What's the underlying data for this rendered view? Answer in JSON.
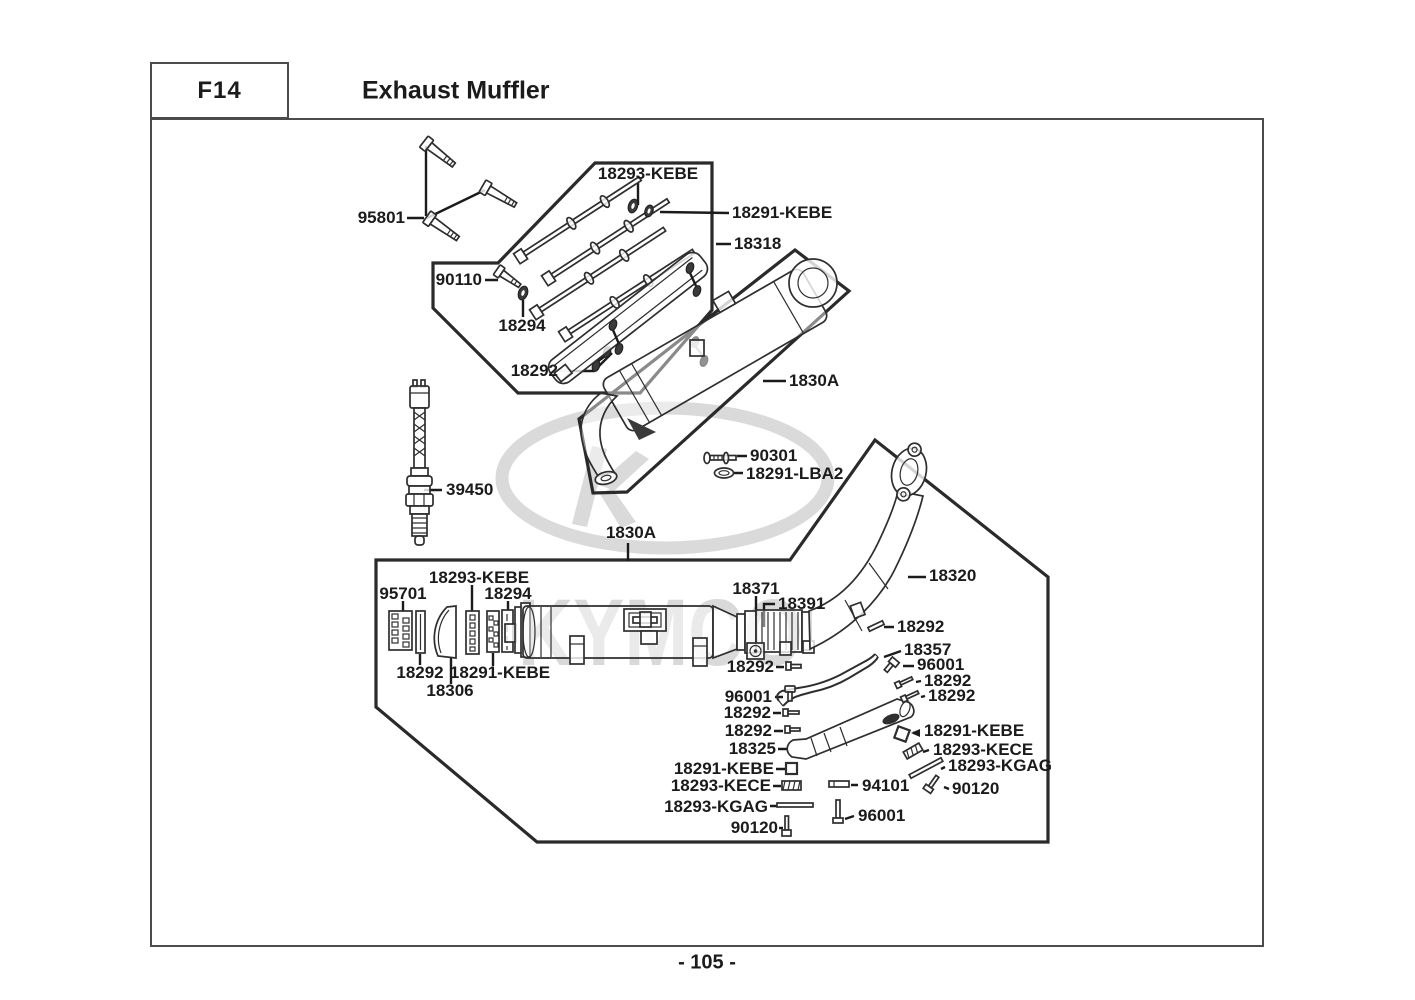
{
  "header": {
    "code": "F14",
    "title": "Exhaust Muffler"
  },
  "footer": {
    "page_number": "- 105 -"
  },
  "watermark": {
    "brand": "KYMCO"
  },
  "diagram": {
    "labels": [
      {
        "text": "95801",
        "x": 405,
        "y": 218,
        "align": "r"
      },
      {
        "text": "18293-KEBE",
        "x": 648,
        "y": 174,
        "align": "c"
      },
      {
        "text": "18291-KEBE",
        "x": 732,
        "y": 213,
        "align": "l"
      },
      {
        "text": "18318",
        "x": 734,
        "y": 244,
        "align": "l"
      },
      {
        "text": "90110",
        "x": 482,
        "y": 280,
        "align": "r"
      },
      {
        "text": "18294",
        "x": 522,
        "y": 326,
        "align": "c"
      },
      {
        "text": "18292",
        "x": 558,
        "y": 371,
        "align": "r"
      },
      {
        "text": "1830A",
        "x": 789,
        "y": 381,
        "align": "l"
      },
      {
        "text": "90301",
        "x": 750,
        "y": 456,
        "align": "l"
      },
      {
        "text": "18291-LBA2",
        "x": 746,
        "y": 474,
        "align": "l"
      },
      {
        "text": "39450",
        "x": 446,
        "y": 490,
        "align": "l"
      },
      {
        "text": "1830A",
        "x": 631,
        "y": 533,
        "align": "c"
      },
      {
        "text": "95701",
        "x": 403,
        "y": 594,
        "align": "c"
      },
      {
        "text": "18293-KEBE",
        "x": 479,
        "y": 578,
        "align": "c"
      },
      {
        "text": "18294",
        "x": 508,
        "y": 594,
        "align": "c"
      },
      {
        "text": "18292",
        "x": 420,
        "y": 673,
        "align": "c"
      },
      {
        "text": "18291-KEBE",
        "x": 500,
        "y": 673,
        "align": "c"
      },
      {
        "text": "18306",
        "x": 450,
        "y": 691,
        "align": "c"
      },
      {
        "text": "18371",
        "x": 756,
        "y": 589,
        "align": "c"
      },
      {
        "text": "18391",
        "x": 778,
        "y": 604,
        "align": "l"
      },
      {
        "text": "18320",
        "x": 929,
        "y": 576,
        "align": "l"
      },
      {
        "text": "18292",
        "x": 897,
        "y": 627,
        "align": "l"
      },
      {
        "text": "18357",
        "x": 904,
        "y": 650,
        "align": "l"
      },
      {
        "text": "96001",
        "x": 917,
        "y": 665,
        "align": "l"
      },
      {
        "text": "18292",
        "x": 924,
        "y": 681,
        "align": "l"
      },
      {
        "text": "18292",
        "x": 928,
        "y": 696,
        "align": "l"
      },
      {
        "text": "18292",
        "x": 774,
        "y": 667,
        "align": "r"
      },
      {
        "text": "96001",
        "x": 772,
        "y": 697,
        "align": "r"
      },
      {
        "text": "18292",
        "x": 771,
        "y": 713,
        "align": "r"
      },
      {
        "text": "18292",
        "x": 772,
        "y": 731,
        "align": "r"
      },
      {
        "text": "18325",
        "x": 776,
        "y": 749,
        "align": "r"
      },
      {
        "text": "18291-KEBE",
        "x": 924,
        "y": 731,
        "align": "l"
      },
      {
        "text": "18293-KECE",
        "x": 933,
        "y": 750,
        "align": "l"
      },
      {
        "text": "18293-KGAG",
        "x": 948,
        "y": 766,
        "align": "l"
      },
      {
        "text": "90120",
        "x": 952,
        "y": 789,
        "align": "l"
      },
      {
        "text": "18291-KEBE",
        "x": 774,
        "y": 769,
        "align": "r"
      },
      {
        "text": "18293-KECE",
        "x": 771,
        "y": 786,
        "align": "r"
      },
      {
        "text": "18293-KGAG",
        "x": 768,
        "y": 807,
        "align": "r"
      },
      {
        "text": "90120",
        "x": 778,
        "y": 828,
        "align": "r"
      },
      {
        "text": "94101",
        "x": 862,
        "y": 786,
        "align": "l"
      },
      {
        "text": "96001",
        "x": 858,
        "y": 816,
        "align": "l"
      }
    ]
  }
}
